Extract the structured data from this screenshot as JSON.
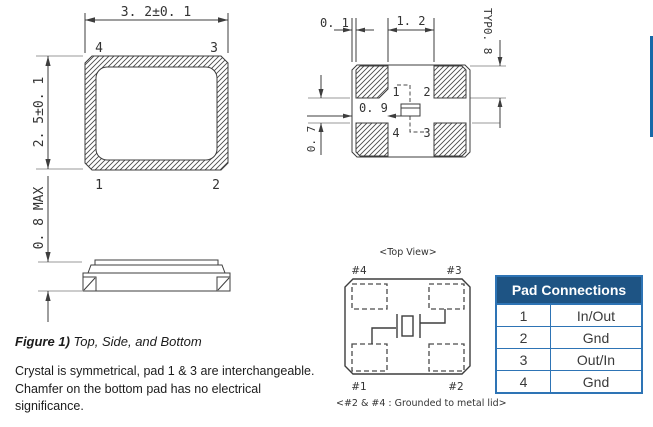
{
  "drawing": {
    "top_view": {
      "dim_width": "3. 2±0. 1",
      "dim_height": "2. 5±0. 1",
      "pad_tl": "4",
      "pad_tr": "3",
      "pad_bl": "1",
      "pad_br": "2"
    },
    "side_view": {
      "dim_height": "0. 8 MAX"
    },
    "bottom_view": {
      "dim_edge_gap": "0. 1",
      "dim_pad_gap": "1. 2",
      "dim_pad_size": "TYP0. 8",
      "dim_center": "0. 9",
      "dim_row_gap": "0. 7",
      "pad_tl": "1",
      "pad_tr": "2",
      "pad_bl": "4",
      "pad_br": "3"
    },
    "schematic": {
      "title": "<Top View>",
      "pad_tl": "#4",
      "pad_tr": "#3",
      "pad_bl": "#1",
      "pad_br": "#2",
      "note": "<#2 & #4 : Grounded to metal lid>"
    }
  },
  "caption": {
    "label": "Figure 1)",
    "text": " Top, Side, and Bottom"
  },
  "notes": {
    "line1": "Crystal is symmetrical, pad 1 & 3 are interchangeable.",
    "line2": "Chamfer on the bottom pad has no electrical",
    "line3": "significance."
  },
  "pad_table": {
    "title": "Pad Connections",
    "rows": [
      {
        "pad": "1",
        "connection": "In/Out"
      },
      {
        "pad": "2",
        "connection": "Gnd"
      },
      {
        "pad": "3",
        "connection": "Out/In"
      },
      {
        "pad": "4",
        "connection": "Gnd"
      }
    ]
  },
  "colors": {
    "table_header_bg": "#1E5484",
    "table_border": "#2E74B5",
    "accent_line": "#1769A8"
  }
}
